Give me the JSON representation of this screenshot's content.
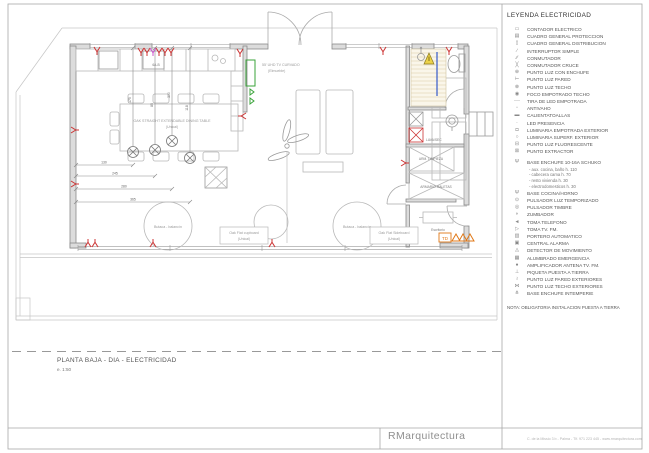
{
  "colors": {
    "red": "#cc3333",
    "magenta": "#cc55cc",
    "green": "#3aa33a",
    "orange": "#e07818",
    "blue": "#4466cc"
  },
  "legend": {
    "title": "LEYENDA ELECTRICIDAD",
    "items": [
      {
        "sym": "▭",
        "label": "CONTADOR ELECTRICO"
      },
      {
        "sym": "▤",
        "label": "CUADRO GENERAL PROTECCION"
      },
      {
        "sym": "▯",
        "label": "CUADRO GENERAL DISTRIBUCION"
      },
      {
        "sym": "∕",
        "label": "INTERRUPTOR SIMPLE"
      },
      {
        "sym": "∕∕",
        "label": "CONMUTADOR"
      },
      {
        "sym": "╳",
        "label": "CONMUTADOR CRUCE"
      },
      {
        "sym": "⊕",
        "label": "PUNTO LUZ CON ENCHUFE"
      },
      {
        "sym": "⊢",
        "label": "PUNTO LUZ PARED"
      },
      {
        "sym": "⊗",
        "label": "PUNTO LUZ TECHO"
      },
      {
        "sym": "◉",
        "label": "FOCO EMPOTRADO TECHO"
      },
      {
        "sym": "┄┄",
        "label": "TIRA DE LED EMPOTRADA"
      },
      {
        "sym": "▫",
        "label": "ANTIVAHO"
      },
      {
        "sym": "▬",
        "label": "CALIENTATOALLAS"
      },
      {
        "sym": "·",
        "label": "LED PRESENCIA"
      },
      {
        "sym": "◘",
        "label": "LUMINARIA EMPOTRADA EXTERIOR"
      },
      {
        "sym": "○",
        "label": "LUMINARIA SUPERF. EXTERIOR"
      },
      {
        "sym": "⊟",
        "label": "PUNTO LUZ FLUORESCENTE"
      },
      {
        "sym": "⊠",
        "label": "PUNTO EXTRACTOR"
      },
      {
        "sym": "Ψ",
        "label": "BASE ENCHUFE 10-16A SCHUKO",
        "gap": true,
        "subs": [
          "- aux. cocina, baño h. 110",
          "- cabecera cama h. 70",
          "- resto vivienda h. 30",
          "- electrodomesticos h. 30"
        ]
      },
      {
        "sym": "Ψ",
        "label": "BASE COCINA/HORNO"
      },
      {
        "sym": "⊙",
        "label": "PULSADOR LUZ TEMPORIZADO"
      },
      {
        "sym": "◎",
        "label": "PULSADOR TIMBRE"
      },
      {
        "sym": "◗",
        "label": "ZUMBADOR"
      },
      {
        "sym": "◄",
        "label": "TOMA TELEFONO"
      },
      {
        "sym": "▷",
        "label": "TOMA TV. FM."
      },
      {
        "sym": "▥",
        "label": "PORTERO AUTOMATICO"
      },
      {
        "sym": "▣",
        "label": "CENTRAL ALARMA"
      },
      {
        "sym": "◬",
        "label": "DETECTOR DE MOVIMIENTO"
      },
      {
        "sym": "▦",
        "label": "ALUMBRADO EMERGENCIA"
      },
      {
        "sym": "●",
        "label": "AMPLIFICADOR ANTENA TV. FM."
      },
      {
        "sym": "⊥",
        "label": "PIQUETA PUESTA A TIERRA"
      },
      {
        "sym": "≀",
        "label": "PUNTO LUZ PARED EXTERIORES"
      },
      {
        "sym": "⋈",
        "label": "PUNTO LUZ TECHO EXTERIORES"
      },
      {
        "sym": "⋔",
        "label": "BASE ENCHUFE INTEMPERIE"
      }
    ],
    "note": "NOTA:  OBLIGATORIA INSTALACION PUESTA A TIERRA"
  },
  "title_block": {
    "title": "PLANTA BAJA - DIA - ELECTRICIDAD",
    "scale": "e. 1:50"
  },
  "footer": {
    "logo": "RMarquitectura",
    "contact": "C. de la Missio 3 b  -  Palma  -  Tlf. 971 223 445  -  www.rmarquitectura.com"
  },
  "plan": {
    "labels": {
      "dining_table": "OAK STRAIGHT EXTENDABLE DINING TABLE",
      "dining_table_sub": "(Unical)",
      "tv": "55' UHD TV CURVADO",
      "tv_sub": "(Elmueble)",
      "armchair_left": "Butaca - balancín",
      "armchair_right": "Butaca - balancín",
      "cupboard": "Oak Flat cupboard",
      "cupboard_sub": "(Unical)",
      "sideboard": "Oak Flat Sideboard",
      "sideboard_sub": "(Unical)",
      "laundry": "LAVA/SEC",
      "closet1": "ARM. LIMPIEZA",
      "closet2": "ARMARIO MALETAS",
      "desk": "Escritorio",
      "td": "TD",
      "socket_tag": "6A-B"
    },
    "dims": {
      "h1": "130",
      "h2": "245",
      "h3": "280",
      "h4": "365",
      "v1": "175",
      "v2": "85",
      "v3": "300",
      "v4": "118"
    }
  }
}
